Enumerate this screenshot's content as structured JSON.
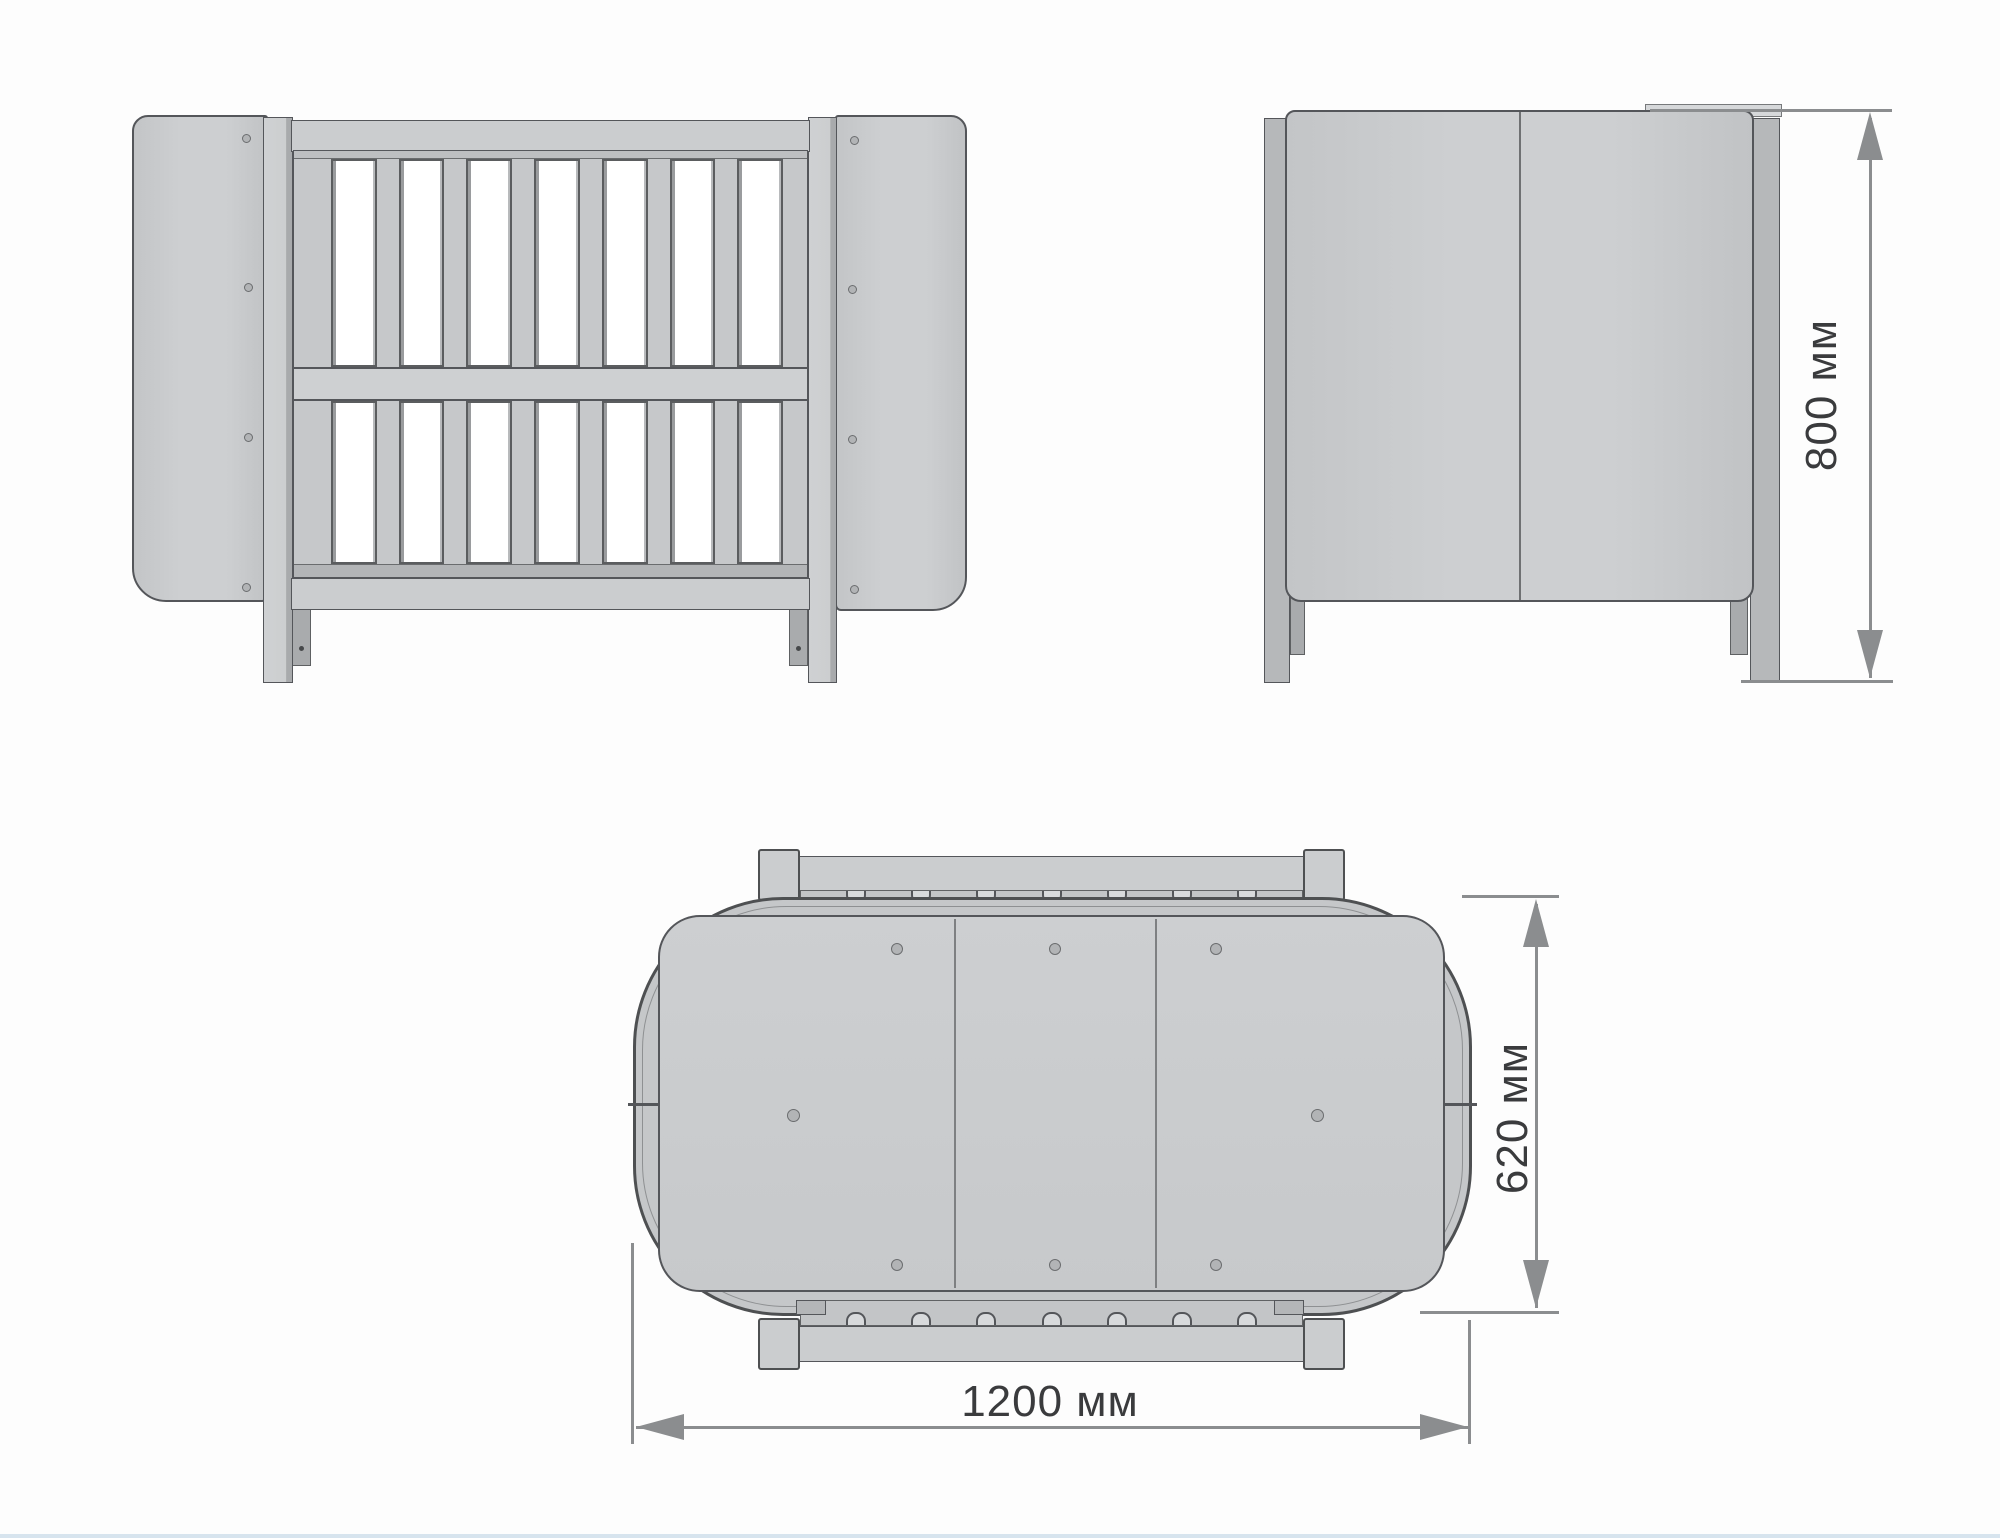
{
  "background": "#fdfdfd",
  "palette": {
    "fill": "#c9cbcd",
    "fill_dark": "#a9abad",
    "fill_light": "#d6d8da",
    "outline": "#54565a",
    "dimension_line": "#8b8d8f",
    "dimension_text": "#3a3b3d",
    "window": "#ffffff"
  },
  "views": {
    "front": {
      "slat_windows_per_row": 7,
      "slat_rows": 2,
      "panel_screw_holes_per_side": 4
    },
    "side": {
      "panel_sections": 2
    },
    "top": {
      "mattress_panels": 3,
      "screw_holes_top_row": 3,
      "screw_holes_bottom_row": 3,
      "screw_holes_middle": 2,
      "slat_notches_per_rail": 7
    }
  },
  "dimensions": {
    "height": {
      "label": "800 мм",
      "value": 800,
      "unit": "мм"
    },
    "width": {
      "label": "620 мм",
      "value": 620,
      "unit": "мм"
    },
    "length": {
      "label": "1200 мм",
      "value": 1200,
      "unit": "мм"
    }
  }
}
